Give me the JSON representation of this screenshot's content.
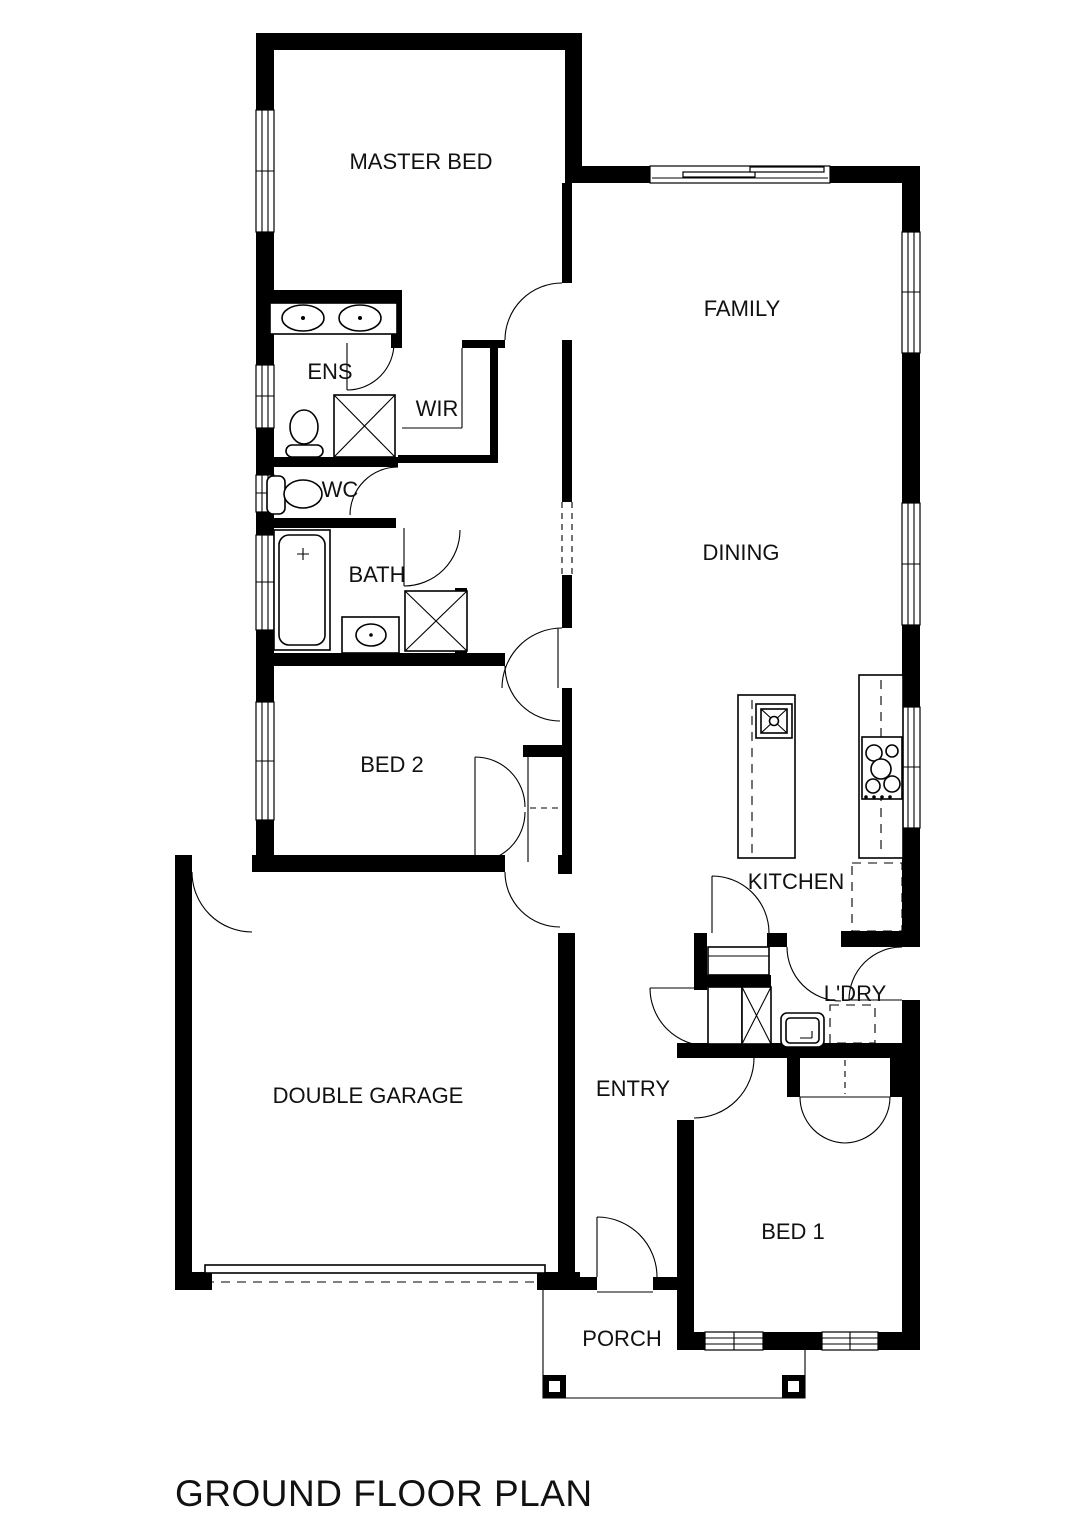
{
  "title": "GROUND FLOOR PLAN",
  "rooms": {
    "master_bed": "MASTER BED",
    "family": "FAMILY",
    "ens": "ENS",
    "wir": "WIR",
    "wc": "WC",
    "bath": "BATH",
    "dining": "DINING",
    "bed2": "BED 2",
    "kitchen": "KITCHEN",
    "ldry": "L'DRY",
    "double_garage": "DOUBLE GARAGE",
    "entry": "ENTRY",
    "bed1": "BED 1",
    "porch": "PORCH"
  },
  "fixtures": {
    "ens": [
      "double-vanity-icon",
      "toilet-icon",
      "shower-icon"
    ],
    "wc": [
      "toilet-icon"
    ],
    "bath": [
      "bathtub-icon",
      "vanity-basin-icon",
      "shower-icon"
    ],
    "wir": [
      "shelf-icon"
    ],
    "bed2": [
      "robe-double-door-icon"
    ],
    "bed1": [
      "robe-double-door-icon"
    ],
    "kitchen": [
      "island-bench-icon",
      "sink-icon",
      "cooktop-icon",
      "fridge-space-icon",
      "pantry-shelf-icon"
    ],
    "ldry": [
      "laundry-tub-icon",
      "washer-space-icon",
      "linen-cupboard-icon"
    ],
    "double_garage": [
      "garage-door-icon",
      "access-door-icon"
    ],
    "entry": [
      "front-door-icon"
    ],
    "porch": [
      "porch-post-icon",
      "porch-post-icon"
    ]
  },
  "colors": {
    "wall": "#000000",
    "line": "#000000",
    "background": "#ffffff",
    "text": "#111111"
  }
}
